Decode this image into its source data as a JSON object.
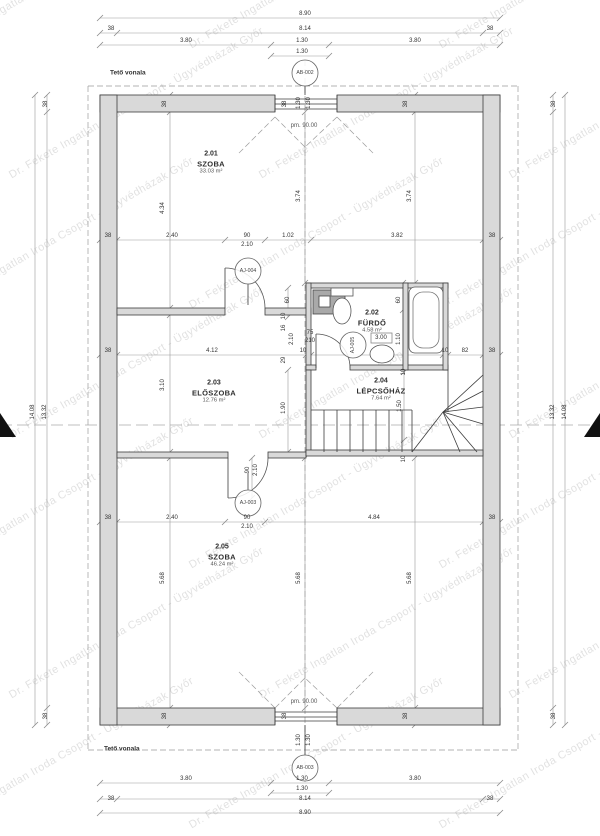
{
  "title": "Emeleti alaprajz",
  "watermark": {
    "text": "Dr. Fekete Ingatlan Iroda Csoport - Ügyvédházak Győr"
  },
  "notes": [
    {
      "t": "Tető vonala",
      "x": 110,
      "y": 73
    },
    {
      "t": "Tető vonala",
      "x": 104,
      "y": 749
    }
  ],
  "pm_labels": [
    {
      "t": "pm. 90.00",
      "x": 304,
      "y": 126
    },
    {
      "t": "pm. 90.00",
      "x": 304,
      "y": 702
    }
  ],
  "rooms": [
    {
      "number": "2.01",
      "name": "SZOBA",
      "area": "33.03 m²",
      "cx": 211,
      "cy": 163
    },
    {
      "number": "2.02",
      "name": "FÜRDŐ",
      "area": "4.58 m²",
      "cx": 372,
      "cy": 322
    },
    {
      "number": "2.03",
      "name": "ELŐSZOBA",
      "area": "12.76 m²",
      "cx": 214,
      "cy": 392
    },
    {
      "number": "2.04",
      "name": "LÉPCSŐHÁZ",
      "area": "7.64 m²",
      "cx": 381,
      "cy": 390
    },
    {
      "number": "2.05",
      "name": "SZOBA",
      "area": "46.24 m²",
      "cx": 222,
      "cy": 556
    }
  ],
  "tags": [
    {
      "label": "AB-002",
      "x": 305,
      "y": 73,
      "rot": 0
    },
    {
      "label": "AB-003",
      "x": 305,
      "y": 768,
      "rot": 0
    },
    {
      "label": "AJ-004",
      "x": 248,
      "y": 271,
      "rot": 0
    },
    {
      "label": "AJ-005",
      "x": 353,
      "y": 345,
      "rot": 1
    },
    {
      "label": "AJ-003",
      "x": 248,
      "y": 503,
      "rot": 0
    }
  ],
  "dims": [
    {
      "t": "8.90",
      "x": 305,
      "y": 14
    },
    {
      "t": "38",
      "x": 111,
      "y": 29
    },
    {
      "t": "8.14",
      "x": 305,
      "y": 29
    },
    {
      "t": "38",
      "x": 490,
      "y": 29
    },
    {
      "t": "3.80",
      "x": 186,
      "y": 41
    },
    {
      "t": "1.30",
      "x": 302,
      "y": 41
    },
    {
      "t": "3.80",
      "x": 415,
      "y": 41
    },
    {
      "t": "1.30",
      "x": 302,
      "y": 52
    },
    {
      "t": "3.80",
      "x": 186,
      "y": 779
    },
    {
      "t": "1.30",
      "x": 302,
      "y": 779
    },
    {
      "t": "3.80",
      "x": 415,
      "y": 779
    },
    {
      "t": "1.30",
      "x": 302,
      "y": 789
    },
    {
      "t": "38",
      "x": 111,
      "y": 799
    },
    {
      "t": "8.14",
      "x": 305,
      "y": 799
    },
    {
      "t": "38",
      "x": 490,
      "y": 799
    },
    {
      "t": "8.90",
      "x": 305,
      "y": 813
    },
    {
      "t": "14.08",
      "x": 33,
      "y": 412,
      "r": 1
    },
    {
      "t": "13.32",
      "x": 45,
      "y": 412,
      "r": 1
    },
    {
      "t": "38",
      "x": 46,
      "y": 104,
      "r": 1
    },
    {
      "t": "38",
      "x": 46,
      "y": 716,
      "r": 1
    },
    {
      "t": "13.32",
      "x": 553,
      "y": 412,
      "r": 1
    },
    {
      "t": "14.08",
      "x": 565,
      "y": 412,
      "r": 1
    },
    {
      "t": "38",
      "x": 554,
      "y": 104,
      "r": 1
    },
    {
      "t": "38",
      "x": 554,
      "y": 716,
      "r": 1
    },
    {
      "t": "38",
      "x": 165,
      "y": 104,
      "r": 1
    },
    {
      "t": "38",
      "x": 285,
      "y": 104,
      "r": 1
    },
    {
      "t": "38",
      "x": 406,
      "y": 104,
      "r": 1
    },
    {
      "t": "38",
      "x": 165,
      "y": 716,
      "r": 1
    },
    {
      "t": "38",
      "x": 285,
      "y": 716,
      "r": 1
    },
    {
      "t": "38",
      "x": 406,
      "y": 716,
      "r": 1
    },
    {
      "t": "1.30",
      "x": 299,
      "y": 103,
      "r": 1
    },
    {
      "t": "1.30",
      "x": 309,
      "y": 103,
      "r": 1
    },
    {
      "t": "1.30",
      "x": 299,
      "y": 740,
      "r": 1
    },
    {
      "t": "1.30",
      "x": 309,
      "y": 740,
      "r": 1
    },
    {
      "t": "38",
      "x": 108,
      "y": 236
    },
    {
      "t": "2.40",
      "x": 172,
      "y": 236
    },
    {
      "t": "90",
      "x": 247,
      "y": 236
    },
    {
      "t": "2.10",
      "x": 247,
      "y": 245
    },
    {
      "t": "1.02",
      "x": 288,
      "y": 236
    },
    {
      "t": "3.82",
      "x": 397,
      "y": 236
    },
    {
      "t": "38",
      "x": 492,
      "y": 236
    },
    {
      "t": "4.34",
      "x": 163,
      "y": 208,
      "r": 1
    },
    {
      "t": "3.74",
      "x": 299,
      "y": 196,
      "r": 1
    },
    {
      "t": "3.74",
      "x": 410,
      "y": 196,
      "r": 1
    },
    {
      "t": "60",
      "x": 288,
      "y": 300,
      "r": 1
    },
    {
      "t": "10",
      "x": 284,
      "y": 316,
      "r": 1
    },
    {
      "t": "16",
      "x": 284,
      "y": 328,
      "r": 1
    },
    {
      "t": "2.10",
      "x": 292,
      "y": 339,
      "r": 1
    },
    {
      "t": "29",
      "x": 284,
      "y": 360,
      "r": 1
    },
    {
      "t": "75",
      "x": 310,
      "y": 333
    },
    {
      "t": "210",
      "x": 310,
      "y": 341
    },
    {
      "t": "60",
      "x": 399,
      "y": 300,
      "r": 1
    },
    {
      "t": "1.10",
      "x": 399,
      "y": 339,
      "r": 1
    },
    {
      "t": "3.00",
      "x": 381,
      "y": 338
    },
    {
      "t": "38",
      "x": 108,
      "y": 351
    },
    {
      "t": "4.12",
      "x": 212,
      "y": 351
    },
    {
      "t": "10",
      "x": 303,
      "y": 351
    },
    {
      "t": "10",
      "x": 445,
      "y": 351
    },
    {
      "t": "82",
      "x": 465,
      "y": 351
    },
    {
      "t": "38",
      "x": 492,
      "y": 351
    },
    {
      "t": "10",
      "x": 404,
      "y": 372,
      "r": 1
    },
    {
      "t": "1.50",
      "x": 400,
      "y": 406,
      "r": 1
    },
    {
      "t": "1.90",
      "x": 284,
      "y": 408,
      "r": 1
    },
    {
      "t": "3.10",
      "x": 163,
      "y": 385,
      "r": 1
    },
    {
      "t": "10",
      "x": 404,
      "y": 459,
      "r": 1
    },
    {
      "t": "90",
      "x": 248,
      "y": 470,
      "r": 1
    },
    {
      "t": "2.10",
      "x": 256,
      "y": 470,
      "r": 1
    },
    {
      "t": "38",
      "x": 108,
      "y": 518
    },
    {
      "t": "2.40",
      "x": 172,
      "y": 518
    },
    {
      "t": "90",
      "x": 247,
      "y": 518
    },
    {
      "t": "2.10",
      "x": 247,
      "y": 527
    },
    {
      "t": "4.84",
      "x": 374,
      "y": 518
    },
    {
      "t": "38",
      "x": 492,
      "y": 518
    },
    {
      "t": "5.68",
      "x": 163,
      "y": 578,
      "r": 1
    },
    {
      "t": "5.68",
      "x": 299,
      "y": 578,
      "r": 1
    },
    {
      "t": "5.68",
      "x": 410,
      "y": 578,
      "r": 1
    }
  ],
  "geometry": {
    "wall_fill": "#d9d9d9",
    "wall_stroke": "#3c3c3c",
    "walls": [
      [
        100,
        95,
        175,
        17
      ],
      [
        337,
        95,
        163,
        17
      ],
      [
        100,
        708,
        175,
        17
      ],
      [
        337,
        708,
        163,
        17
      ],
      [
        100,
        95,
        17,
        630
      ],
      [
        483,
        95,
        17,
        630
      ],
      [
        117,
        308,
        108,
        7
      ],
      [
        265,
        308,
        46,
        7
      ],
      [
        306,
        283,
        142,
        5
      ],
      [
        306,
        283,
        5,
        87
      ],
      [
        306,
        365,
        10,
        5
      ],
      [
        350,
        365,
        98,
        5
      ],
      [
        403,
        283,
        5,
        87
      ],
      [
        443,
        283,
        5,
        87
      ],
      [
        306,
        370,
        5,
        82
      ],
      [
        117,
        452,
        111,
        6
      ],
      [
        268,
        452,
        38,
        6
      ],
      [
        306,
        450,
        177,
        6
      ]
    ],
    "fixtures": [
      {
        "type": "rect",
        "name": "washing-machine",
        "x": 313,
        "y": 290,
        "w": 32,
        "h": 24,
        "fill": "#a9a9a9",
        "stroke": "#444"
      },
      {
        "type": "rect",
        "name": "washing-machine-door",
        "x": 319,
        "y": 296,
        "w": 11,
        "h": 11,
        "fill": "#ffffff",
        "stroke": "#444"
      },
      {
        "type": "rect",
        "name": "wc-tank",
        "x": 331,
        "y": 288,
        "w": 22,
        "h": 8,
        "fill": "#ffffff",
        "stroke": "#555"
      },
      {
        "type": "ellipse",
        "name": "wc-bowl",
        "cx": 342,
        "cy": 311,
        "rx": 9,
        "ry": 13,
        "fill": "#ffffff",
        "stroke": "#555"
      },
      {
        "type": "rrect",
        "name": "bathtub-outer",
        "x": 409,
        "y": 287,
        "w": 34,
        "h": 66,
        "r": 6,
        "fill": "#ffffff",
        "stroke": "#555"
      },
      {
        "type": "rrect",
        "name": "bathtub-inner",
        "x": 413,
        "y": 292,
        "w": 26,
        "h": 56,
        "r": 10,
        "fill": "none",
        "stroke": "#777"
      },
      {
        "type": "ellipse",
        "name": "washbasin",
        "cx": 382,
        "cy": 354,
        "rx": 12,
        "ry": 9,
        "fill": "#ffffff",
        "stroke": "#555"
      },
      {
        "type": "rect",
        "name": "washbasin-tag-box",
        "x": 371,
        "y": 333,
        "w": 21,
        "h": 10,
        "fill": "none",
        "stroke": "#888"
      }
    ],
    "lines": [
      [
        275,
        95,
        275,
        112
      ],
      [
        337,
        95,
        337,
        112
      ],
      [
        275,
        99,
        337,
        99
      ],
      [
        275,
        104,
        337,
        104
      ],
      [
        275,
        109,
        337,
        109
      ],
      [
        275,
        708,
        275,
        725
      ],
      [
        337,
        708,
        337,
        725
      ],
      [
        275,
        712,
        337,
        712
      ],
      [
        275,
        717,
        337,
        717
      ],
      [
        275,
        721,
        337,
        721
      ],
      [
        311,
        410,
        412,
        410
      ],
      [
        412,
        410,
        412,
        452
      ],
      [
        324,
        410,
        324,
        452
      ],
      [
        337,
        410,
        337,
        452
      ],
      [
        350,
        410,
        350,
        452
      ],
      [
        363,
        410,
        363,
        452
      ],
      [
        376,
        410,
        376,
        452
      ],
      [
        389,
        410,
        389,
        452
      ],
      [
        402,
        410,
        402,
        452
      ],
      [
        412,
        452,
        443,
        412
      ],
      [
        443,
        412,
        483,
        375
      ],
      [
        443,
        412,
        483,
        391
      ],
      [
        443,
        412,
        483,
        407
      ],
      [
        443,
        412,
        483,
        424
      ],
      [
        443,
        412,
        477,
        452
      ],
      [
        443,
        412,
        460,
        452
      ],
      [
        448,
        370,
        448,
        412
      ],
      [
        225,
        308,
        225,
        268
      ],
      [
        316,
        368,
        316,
        334
      ],
      [
        228,
        458,
        228,
        498
      ],
      [
        248,
        284,
        248,
        305
      ],
      [
        248,
        490,
        248,
        473
      ],
      [
        305,
        86,
        305,
        95
      ],
      [
        305,
        725,
        305,
        755
      ]
    ],
    "doors": [
      "M225,268 A40,40 0 0 1 265,308",
      "M316,334 A34,34 0 0 1 350,368",
      "M228,498 A40,40 0 0 0 268,458"
    ],
    "dashed": [
      [
        88,
        86,
        518,
        86
      ],
      [
        88,
        750,
        518,
        750
      ],
      [
        88,
        86,
        88,
        750
      ],
      [
        518,
        86,
        518,
        750
      ],
      [
        305,
        60,
        305,
        782
      ],
      [
        275,
        117,
        237,
        155
      ],
      [
        337,
        117,
        375,
        155
      ],
      [
        275,
        117,
        305,
        147
      ],
      [
        337,
        117,
        305,
        147
      ],
      [
        275,
        708,
        237,
        670
      ],
      [
        337,
        708,
        375,
        670
      ],
      [
        275,
        708,
        305,
        678
      ],
      [
        337,
        708,
        305,
        678
      ]
    ],
    "section_line": [
      0,
      425,
      600,
      425
    ],
    "section_triangles": [
      [
        [
          0,
          413
        ],
        [
          16,
          437
        ],
        [
          0,
          437
        ]
      ],
      [
        [
          600,
          413
        ],
        [
          584,
          437
        ],
        [
          600,
          437
        ]
      ]
    ],
    "dim_lines_h": [
      {
        "y": 18,
        "x1": 100,
        "x2": 500,
        "ticks": [
          100,
          500
        ]
      },
      {
        "y": 33,
        "x1": 100,
        "x2": 500,
        "ticks": [
          100,
          117,
          483,
          500
        ]
      },
      {
        "y": 45,
        "x1": 100,
        "x2": 500,
        "ticks": [
          100,
          271,
          329,
          500
        ]
      },
      {
        "y": 56,
        "x1": 271,
        "x2": 329,
        "ticks": [
          271,
          329
        ]
      },
      {
        "y": 783,
        "x1": 100,
        "x2": 500,
        "ticks": [
          100,
          271,
          329,
          500
        ]
      },
      {
        "y": 793,
        "x1": 271,
        "x2": 329,
        "ticks": [
          271,
          329
        ]
      },
      {
        "y": 799,
        "x1": 100,
        "x2": 500,
        "ticks": [
          100,
          117,
          483,
          500
        ]
      },
      {
        "y": 813,
        "x1": 100,
        "x2": 500,
        "ticks": [
          100,
          500
        ]
      },
      {
        "y": 240,
        "x1": 100,
        "x2": 500,
        "ticks": [
          100,
          117,
          225,
          265,
          311,
          483,
          500
        ]
      },
      {
        "y": 355,
        "x1": 100,
        "x2": 500,
        "ticks": [
          100,
          117,
          306,
          311,
          443,
          448,
          483,
          500
        ]
      },
      {
        "y": 522,
        "x1": 100,
        "x2": 500,
        "ticks": [
          100,
          117,
          225,
          265,
          483,
          500
        ]
      }
    ],
    "dim_lines_v": [
      {
        "x": 35,
        "y1": 95,
        "y2": 725,
        "ticks": [
          95,
          725
        ]
      },
      {
        "x": 47,
        "y1": 95,
        "y2": 725,
        "ticks": [
          95,
          112,
          708,
          725
        ]
      },
      {
        "x": 553,
        "y1": 95,
        "y2": 725,
        "ticks": [
          95,
          112,
          708,
          725
        ]
      },
      {
        "x": 565,
        "y1": 95,
        "y2": 725,
        "ticks": [
          95,
          725
        ]
      },
      {
        "x": 170,
        "y1": 95,
        "y2": 308,
        "ticks": [
          95,
          112,
          308
        ]
      },
      {
        "x": 305,
        "y1": 112,
        "y2": 283,
        "ticks": [
          112,
          283
        ]
      },
      {
        "x": 415,
        "y1": 95,
        "y2": 283,
        "ticks": [
          95,
          112,
          283
        ]
      },
      {
        "x": 170,
        "y1": 315,
        "y2": 452,
        "ticks": [
          315,
          452
        ]
      },
      {
        "x": 288,
        "y1": 370,
        "y2": 452,
        "ticks": [
          370,
          452
        ]
      },
      {
        "x": 404,
        "y1": 372,
        "y2": 440,
        "ticks": [
          372,
          440
        ]
      },
      {
        "x": 170,
        "y1": 458,
        "y2": 725,
        "ticks": [
          458,
          708,
          725
        ]
      },
      {
        "x": 305,
        "y1": 458,
        "y2": 708,
        "ticks": [
          458,
          708
        ]
      },
      {
        "x": 415,
        "y1": 458,
        "y2": 725,
        "ticks": [
          458,
          708,
          725
        ]
      },
      {
        "x": 403,
        "y1": 283,
        "y2": 365,
        "ticks": [
          283,
          310,
          365
        ]
      },
      {
        "x": 288,
        "y1": 288,
        "y2": 317,
        "ticks": [
          288,
          317
        ]
      },
      {
        "x": 252,
        "y1": 458,
        "y2": 498,
        "ticks": [
          458,
          498
        ]
      }
    ]
  }
}
